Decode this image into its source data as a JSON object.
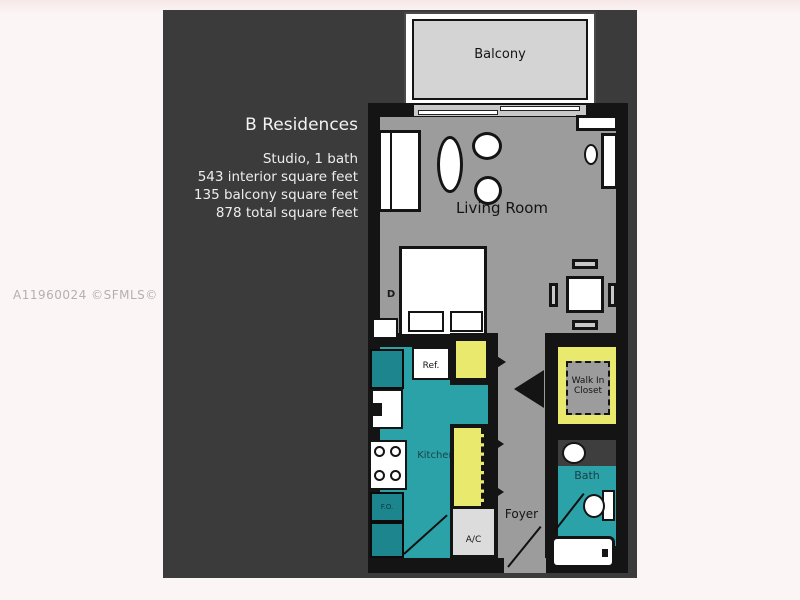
{
  "listing": {
    "watermark": "A11960024 ©SFMLS© 2/26/2019",
    "building_name": "B Residences",
    "details": [
      "Studio, 1 bath",
      "543 interior square feet",
      "135 balcony square feet",
      "878 total square feet"
    ]
  },
  "floorplan": {
    "balcony": "Balcony",
    "living_room": "Living Room",
    "kitchen": "Kitchen",
    "refrigerator": "Ref.",
    "walk_in_closet": "Walk In\nCloset",
    "bath": "Bath",
    "foyer": "Foyer",
    "ac": "A/C",
    "bed_marker": "D",
    "cabinet_marker": "F.O."
  },
  "colors": {
    "page_bg": "#fbf5f5",
    "panel_bg": "#3b3b3b",
    "floor_gray": "#9c9c9c",
    "balcony_floor": "#d4d4d4",
    "wet_floor_teal": "#2ba1a8",
    "closet_yellow": "#e9e96e",
    "wall_black": "#141414"
  }
}
